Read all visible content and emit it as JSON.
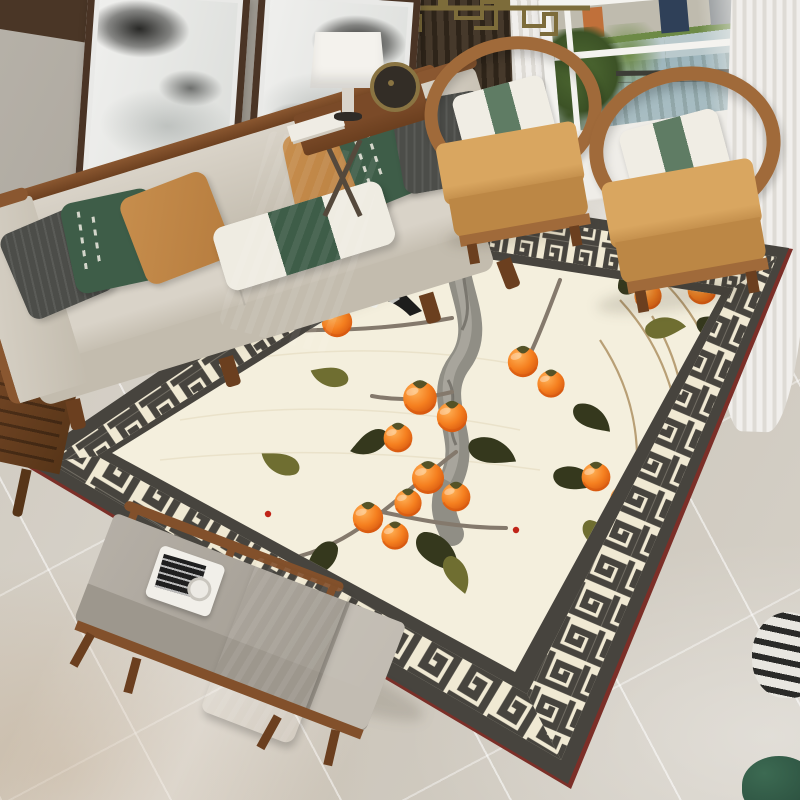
{
  "meta": {
    "domain": "Natural-Image",
    "description": "Lifestyle photo of a Chinese-style living room centered on a large cream area rug with an ink-brush persimmon branch motif, a magpie bird, and a charcoal Greek-key meander border"
  },
  "scene": {
    "wall_art": {
      "label": "two framed ink-wash landscape paintings",
      "count": 2,
      "frame": "dark walnut wood"
    },
    "lighting": {
      "label": "brass geometric fret chandelier"
    },
    "partition": {
      "label": "vertical wood slat screen"
    },
    "curtains": {
      "label": "white sheer curtains and dark brown drape"
    },
    "window": {
      "label": "window with riverfront city view",
      "elements": [
        "buildings",
        "trees",
        "river water",
        "pier bridge",
        "boat"
      ]
    },
    "sofa": {
      "label": "wood-frame sofa with light gray upholstery",
      "pillows": [
        "charcoal fern-embossed pillow",
        "dark green pillow with white calligraphy",
        "amber orange pillow",
        "white lumbar pillow with green center band",
        "amber orange pillow",
        "dark green pillow with white calligraphy",
        "charcoal fern-embossed pillow"
      ],
      "throw": "dark green blanket draped over seat onto rug"
    },
    "armchairs": {
      "label": "two wooden horseshoe-back armchairs",
      "count": 2,
      "cushion": "camel tan",
      "pillow": "white with sage green band"
    },
    "side_table": {
      "label": "wood side table with X base",
      "items": [
        "white drum table lamp",
        "bronze disc ornament",
        "stack of books"
      ]
    },
    "bench": {
      "label": "upholstered wood bench",
      "cushion": "warm gray",
      "runner": "dark green cloth",
      "tray_items": [
        "white tray",
        "black-and-white magazine",
        "glass cup"
      ]
    },
    "rug": {
      "label": "Chinese persimmon-branch area rug with Greek key border",
      "field_color_name": "cream",
      "border": "charcoal Greek-key meander band on cream with dark outer band and red edge trim",
      "motif": {
        "trunk": "gnarled ink-brush branch",
        "fruits": "orange persimmons",
        "fruit_count": 16,
        "leaves": [
          "dark olive",
          "sage olive"
        ],
        "bird": "black-and-white magpie perched on branch",
        "accents": [
          "dry tan twigs",
          "tiny red buds"
        ]
      }
    },
    "floor": {
      "label": "polished marble tile floor"
    },
    "accessories": [
      "carved wood stool",
      "black-and-white striped vase",
      "dark green planter"
    ]
  },
  "counts": {
    "paintings": 2,
    "armchairs": 2,
    "sofa_pillows": 7,
    "persimmons": 16
  },
  "palette": {
    "wall": "#b6b1a8",
    "wallDark": "#a39d93",
    "wedge": "#4a3626",
    "frameWood": "#4a3425",
    "artPaper": "#e9e9e7",
    "sofaFabric": "#d9d3c8",
    "sofaFabricDark": "#c3bcae",
    "sofaWood": "#8a5730",
    "woodDark": "#6b3f1f",
    "pillowDark": "#4c4d49",
    "pillowGreen": "#3e5d48",
    "pillowOrange": "#c78e4d",
    "pillowWhite": "#efece2",
    "throwGreen": "#3a5c46",
    "chairWood": "#a06a3a",
    "chairCushion": "#d9a660",
    "chairCushionDark": "#bc8745",
    "chairPillow": "#f0ede4",
    "chairBand": "#5f7c64",
    "rugEdgeRed": "#7c2f28",
    "rugDark": "#47443e",
    "rugCream": "#f0e9d3",
    "rugField": "#f4efdd",
    "fieldLine": "#e7dfc6",
    "persimmonLight": "#ffb257",
    "persimmonMid": "#f57f1f",
    "persimmonDark": "#d4540e",
    "leafDark": "#35381d",
    "leafOlive": "#6f6e31",
    "leafMid": "#4c4f26",
    "trunk": "#908e85",
    "trunkLight": "#aeaba1",
    "trunkDark": "#66645c",
    "branch": "#84796c",
    "twig": "#b2966a",
    "budRed": "#c02418",
    "birdBlack": "#1d1d1c",
    "birdWhite": "#f2f2ee",
    "beak": "#b5a33c",
    "floorA": "#d6d1c8",
    "floorB": "#cdc7bc",
    "curtainDark": "#46392b",
    "curtainDark2": "#2e2419",
    "slat": "#7d5c3e",
    "sheerA": "#f1efec",
    "sheerB": "#dedbd5",
    "windowFrame": "#f4f3ef",
    "skyStrip": "#bfbbae",
    "bldOrange": "#c0703a",
    "bldBlue": "#2f4058",
    "bldGray": "#8a8f93",
    "treeA": "#4f6b33",
    "treeB": "#6d8a46",
    "treeC": "#3c5226",
    "waterA": "#9eb6bd",
    "waterB": "#b9c9cc",
    "pier": "#3d3d36",
    "boat": "#2e3133",
    "brass": "#7d6c3a",
    "benchCushion": "#b5afa6",
    "benchCushionDark": "#9d978d",
    "benchWood": "#82502b",
    "trayWhite": "#f1efe9",
    "magDark": "#1f1f1f",
    "lampShade": "#f4f2ed",
    "lampStem": "#d9d4cb",
    "lampBase": "#2f2b27",
    "discDark": "#332d26",
    "discRing": "#8a7442",
    "tableWood": "#7a4a28",
    "legMetal": "#55493c",
    "bookWhite": "#efece4",
    "stoolA": "#7a4a28",
    "stoolB": "#573518",
    "vaseA": "#e8e6e0",
    "vaseB": "#2a2a28",
    "potA": "#3c6a52",
    "potB": "#27493a",
    "sillA": "#efede8",
    "sillB": "#ddd9d2"
  }
}
